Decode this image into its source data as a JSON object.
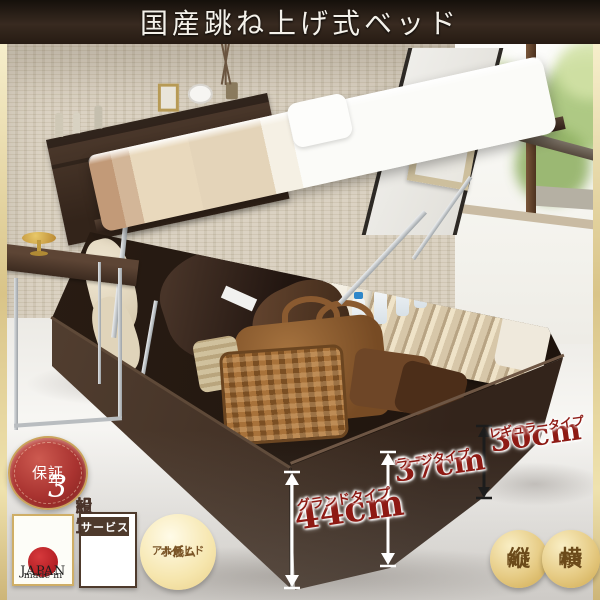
{
  "banner": {
    "title": "国産跳ね上げ式ベッド"
  },
  "badges": {
    "warranty": {
      "digit": "3",
      "unit": "年",
      "label": "保証"
    },
    "made_in_japan": {
      "line1": "made in",
      "line2": "JAPAN"
    },
    "assembly": {
      "row1": "組立",
      "row2": "設置",
      "footer": "サービス"
    },
    "low_formaldehyde": {
      "line1": "低",
      "line2": "ホルム",
      "line3": "アルデヒド"
    },
    "open_vertical": {
      "main": "縦",
      "sub": "開き"
    },
    "open_horizontal": {
      "main": "横",
      "sub": "開き"
    }
  },
  "measurements": [
    {
      "value": "44cm",
      "label": "グランドタイプ"
    },
    {
      "value": "37cm",
      "label": "ラージタイプ"
    },
    {
      "value": "30cm",
      "label": "レギュラータイプ"
    }
  ],
  "colors": {
    "banner_bg": "#2a1f17",
    "accent_red": "#8e1a14",
    "badge_red": "#a93330",
    "gold_trim": "#d9c488",
    "bed_brown": "#43322a"
  }
}
